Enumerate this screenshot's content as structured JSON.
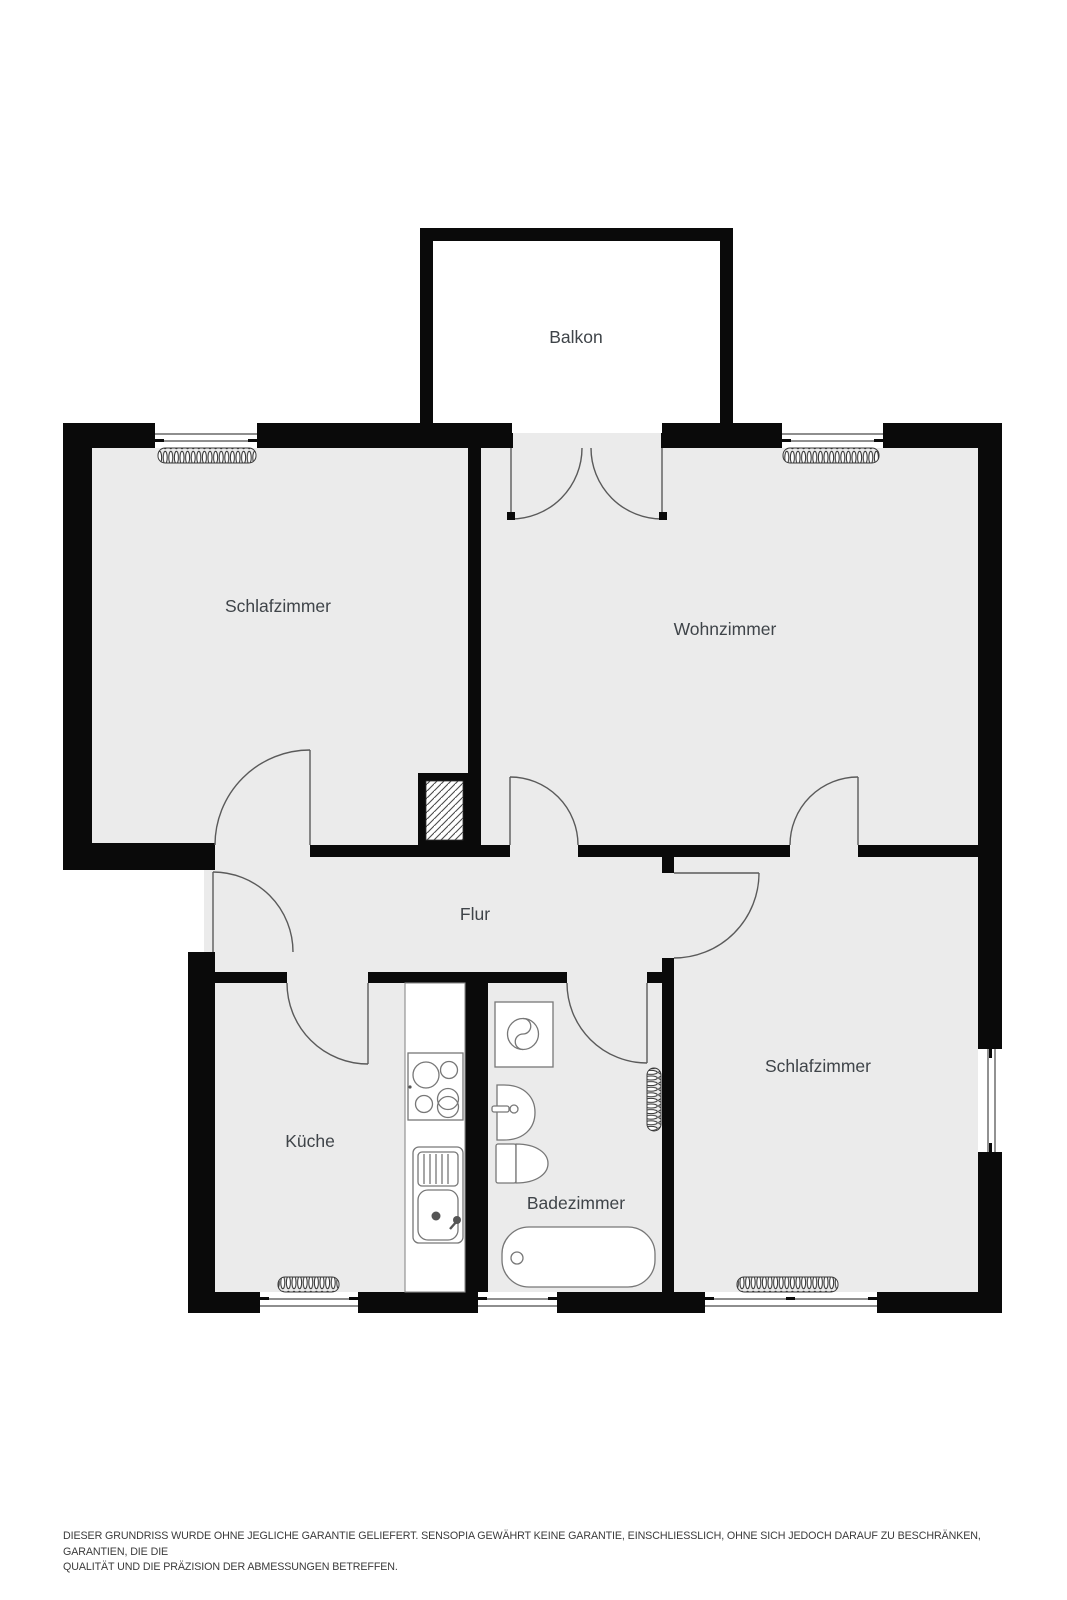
{
  "title": "Grundriss Wohnung",
  "rooms": {
    "balkon": {
      "label": "Balkon"
    },
    "schlafzimmer_top": {
      "label": "Schlafzimmer"
    },
    "wohnzimmer": {
      "label": "Wohnzimmer"
    },
    "flur": {
      "label": "Flur"
    },
    "kueche": {
      "label": "Küche"
    },
    "badezimmer": {
      "label": "Badezimmer"
    },
    "schlafzimmer_bottom": {
      "label": "Schlafzimmer"
    }
  },
  "fixtures": [
    "stove",
    "kitchen-sink",
    "washing-machine",
    "bathroom-sink",
    "toilet",
    "bathtub",
    "radiator"
  ],
  "disclaimer": {
    "line1": "DIESER GRUNDRISS WURDE OHNE JEGLICHE GARANTIE GELIEFERT. SENSOPIA GEWÄHRT KEINE GARANTIE, EINSCHLIESSLICH, OHNE SICH JEDOCH DARAUF ZU BESCHRÄNKEN, GARANTIEN, DIE DIE",
    "line2": "QUALITÄT UND DIE PRÄZISION DER ABMESSUNGEN BETREFFEN."
  },
  "colors": {
    "wall": "#0a0a0a",
    "floor": "#ebebeb",
    "background": "#ffffff",
    "fixture_stroke": "#777777",
    "door_stroke": "#5a5a5a",
    "label_text": "#3f4449",
    "disclaimer_text": "#3b3b3b"
  }
}
